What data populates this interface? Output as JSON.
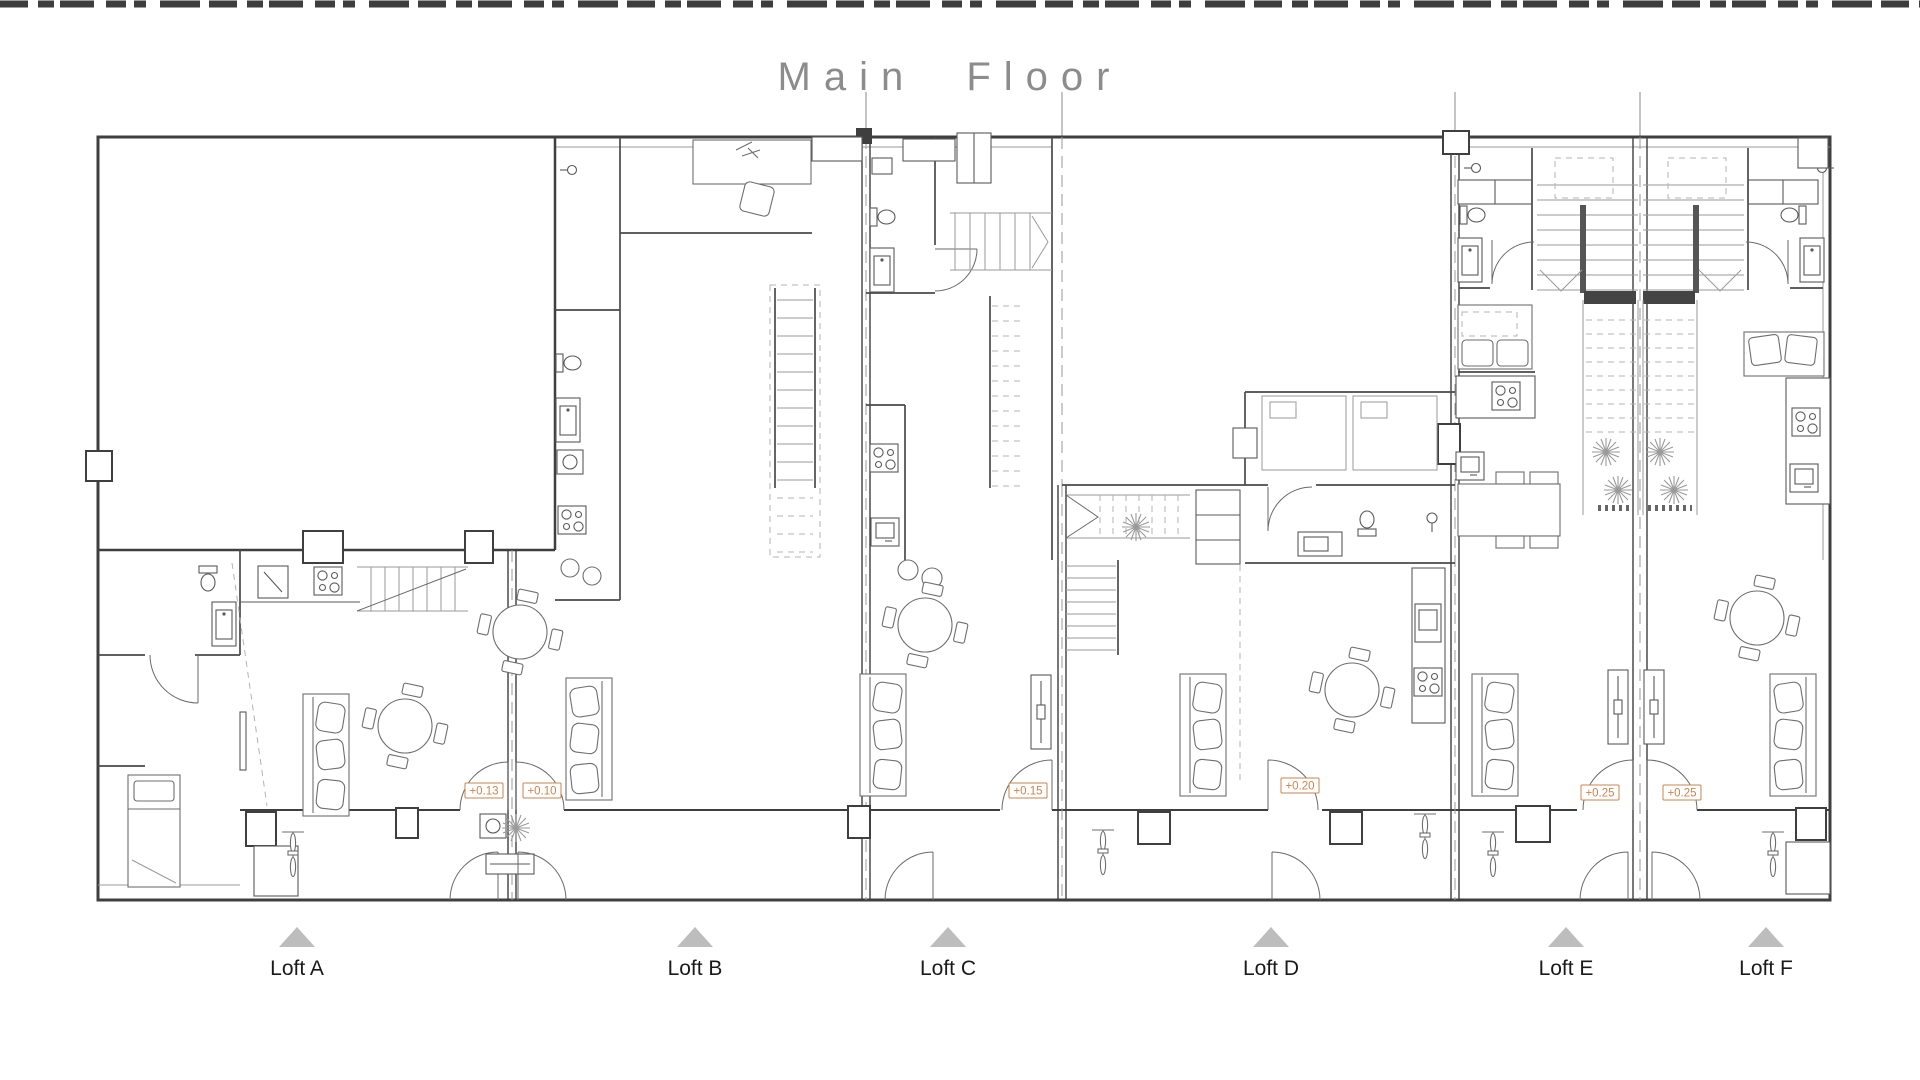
{
  "title": "Main Floor",
  "lofts": [
    {
      "id": "A",
      "label": "Loft A"
    },
    {
      "id": "B",
      "label": "Loft B"
    },
    {
      "id": "C",
      "label": "Loft C"
    },
    {
      "id": "D",
      "label": "Loft D"
    },
    {
      "id": "E",
      "label": "Loft E"
    },
    {
      "id": "F",
      "label": "Loft F"
    }
  ],
  "elevation_markers": [
    {
      "value": "+0.13",
      "loft": "A"
    },
    {
      "value": "+0.10",
      "loft": "B"
    },
    {
      "value": "+0.15",
      "loft": "C"
    },
    {
      "value": "+0.20",
      "loft": "D"
    },
    {
      "value": "+0.25",
      "loft": "E"
    },
    {
      "value": "+0.25",
      "loft": "F"
    }
  ],
  "colors": {
    "wall_line": "#3f3f3f",
    "furniture_line": "#6e6e6e",
    "light_line": "#9a9a9a",
    "elevation_accent": "#c9854f",
    "section_triangle": "#bdbdbd",
    "title_text": "#8c8c8c",
    "label_text": "#1a1a1a"
  },
  "icons": [
    "toilet-icon",
    "sink-icon",
    "stove-icon",
    "sofa-icon",
    "bed-icon",
    "round-table-icon",
    "dining-table-icon",
    "desk-icon",
    "stairs-icon",
    "bicycle-icon",
    "plant-icon",
    "washer-icon",
    "shower-icon",
    "tv-icon",
    "door-arc-icon",
    "section-triangle-icon"
  ]
}
